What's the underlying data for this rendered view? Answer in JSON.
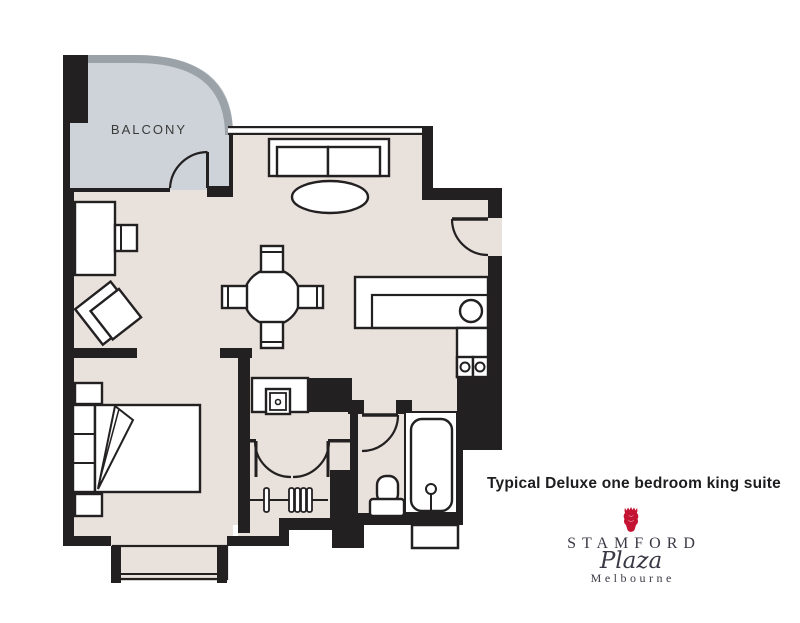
{
  "plan": {
    "balcony_label": "BALCONY",
    "caption": "Typical Deluxe one bedroom king suite"
  },
  "brand": {
    "name": "STAMFORD",
    "script": "Plaza",
    "city": "Melbourne",
    "icon": "crown-icon"
  },
  "colors": {
    "floor": "#e9e1db",
    "balcony": "#cdd3d8",
    "wall": "#232021",
    "balcony_rail": "#9ba2a8",
    "brand_red": "#c41434",
    "brand_text": "#3a3a46",
    "caption_text": "#1d1d1f"
  }
}
